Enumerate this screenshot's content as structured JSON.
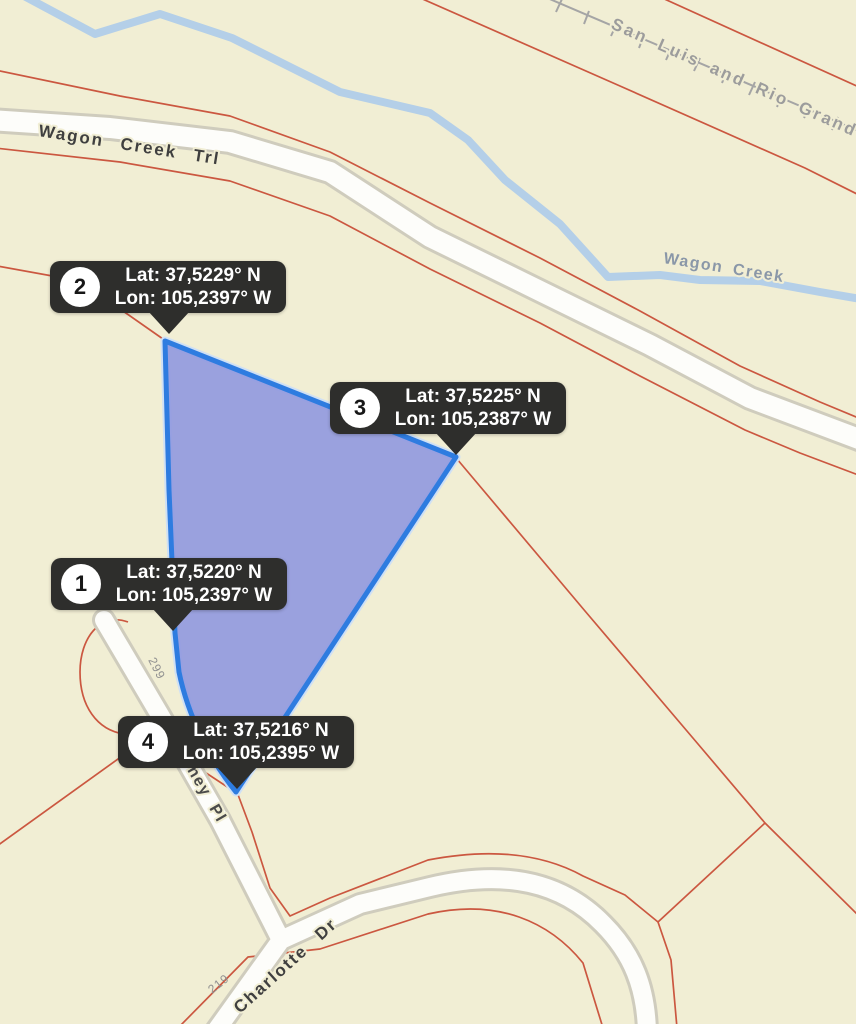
{
  "map": {
    "colors": {
      "background": "#f1eed4",
      "parcel_line": "#cb5740",
      "road_fill": "#fdfdfa",
      "road_casing": "#cfccbd",
      "creek": "#b4cfe8",
      "railroad": "#a5a5a5",
      "selection_fill": "#939ade",
      "selection_stroke": "#2e7ce0",
      "selection_halo": "#cfe0f5",
      "tooltip_bg": "#2e2e2c"
    },
    "labels": {
      "road_main": "Wagon Creek Trl",
      "railroad": "San Luis and Rio Grande",
      "creek": "Wagon Creek",
      "road_place": "ney Pl",
      "road_charlotte": "Charlotte Dr",
      "lot_number_299": "299",
      "lot_number_219": "219"
    },
    "markers": [
      {
        "num": "1",
        "lat": "Lat: 37,5220° N",
        "lon": "Lon: 105,2397° W"
      },
      {
        "num": "2",
        "lat": "Lat: 37,5229° N",
        "lon": "Lon: 105,2397° W"
      },
      {
        "num": "3",
        "lat": "Lat: 37,5225° N",
        "lon": "Lon: 105,2387° W"
      },
      {
        "num": "4",
        "lat": "Lat: 37,5216° N",
        "lon": "Lon: 105,2395° W"
      }
    ]
  }
}
